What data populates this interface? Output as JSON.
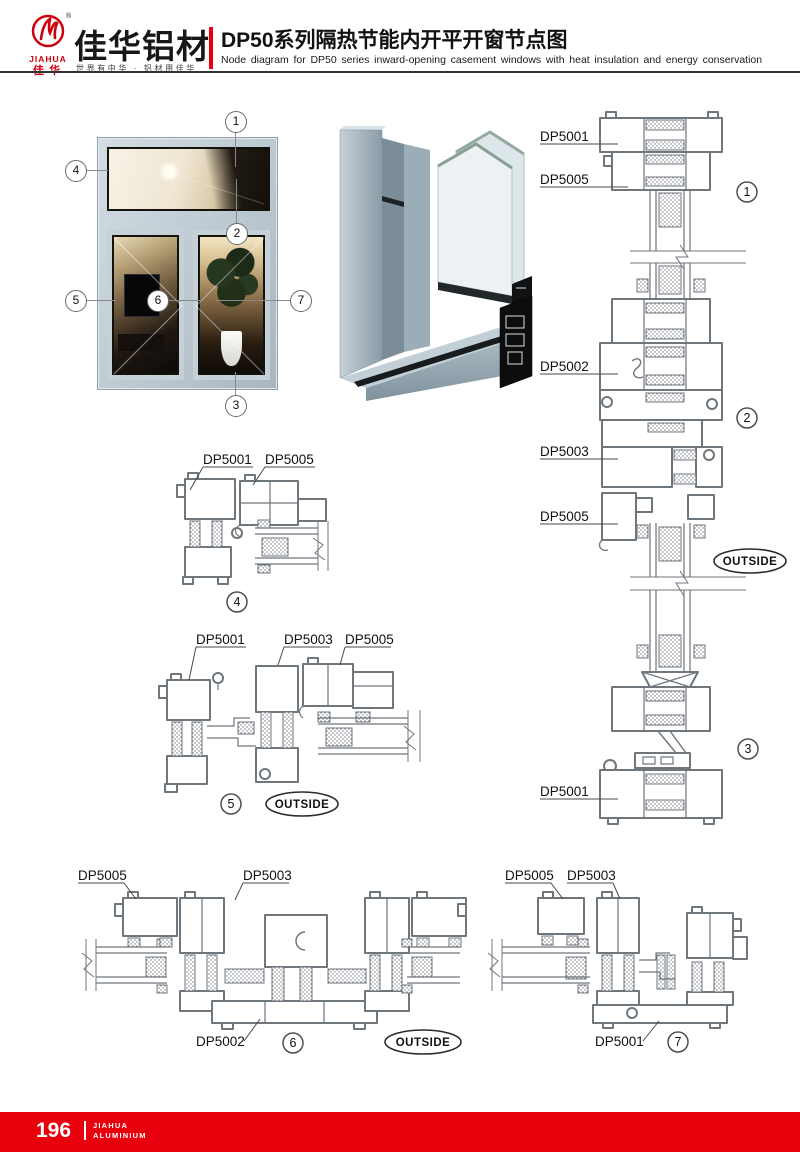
{
  "header": {
    "logo": {
      "registered": "®",
      "brand_en": "JIAHUA",
      "brand_cn": "佳华",
      "company_name": "佳华铝材",
      "tagline": "世界有中华 · 铝材用佳华"
    },
    "title_cn": "DP50系列隔热节能内开平开窗节点图",
    "title_en": "Node diagram for DP50 series inward-opening casement windows with heat insulation and energy conservation"
  },
  "photo": {
    "callouts": [
      "1",
      "2",
      "3",
      "4",
      "5",
      "6",
      "7"
    ]
  },
  "right_col": {
    "labels": [
      "DP5001",
      "DP5005",
      "DP5002",
      "DP5003",
      "DP5005",
      "DP5001"
    ],
    "details": [
      "1",
      "2",
      "3"
    ],
    "outside": "OUTSIDE"
  },
  "detail4": {
    "labels": [
      "DP5001",
      "DP5005"
    ],
    "num": "4"
  },
  "detail5": {
    "labels": [
      "DP5001",
      "DP5003",
      "DP5005"
    ],
    "num": "5",
    "outside": "OUTSIDE"
  },
  "detail6": {
    "labels_top": [
      "DP5005",
      "DP5003"
    ],
    "label_bottom": "DP5002",
    "num": "6",
    "outside": "OUTSIDE"
  },
  "detail7": {
    "labels_top": [
      "DP5005",
      "DP5003"
    ],
    "label_bottom": "DP5001",
    "num": "7"
  },
  "footer": {
    "page_number": "196",
    "brand_line1": "JIAHUA",
    "brand_line2": "ALUMINIUM"
  },
  "colors": {
    "accent_red": "#e8000d",
    "drawing_stroke": "#6f767c",
    "frame_blue_gray": "#b9c6cd"
  }
}
